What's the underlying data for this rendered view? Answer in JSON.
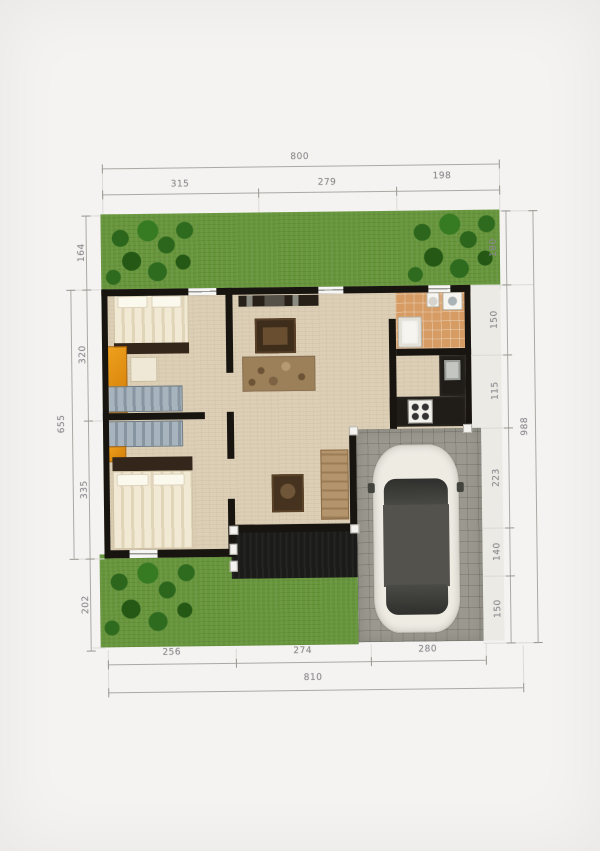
{
  "colors": {
    "bg": "#f4f3f1",
    "grass": "#66953b",
    "floor": "#dccfb6",
    "wall": "#181510",
    "carport": "#9b998f",
    "terrace": "#1b1b19",
    "bath-tile": "#d69c64",
    "furniture-orange": "#d07c08",
    "furniture-brown": "#3f2d1c",
    "rug": "#9c8059",
    "bed-cream": "#f2e9d4",
    "bed-stripe": "#e0d5b8",
    "closet-gray": "#a8b4bd",
    "car-body": "#edebe2",
    "car-glass": "#53524c",
    "dim-line": "#a9a9a4",
    "dim-text": "#8b8b90"
  },
  "dimensions": {
    "top": {
      "total": "800",
      "segments": [
        "315",
        "279",
        "198"
      ]
    },
    "bottom": {
      "total": "810",
      "segments": [
        "256",
        "274",
        "280"
      ]
    },
    "left": {
      "outer": "655",
      "segments": [
        "164",
        "320",
        "335",
        "202"
      ]
    },
    "right": {
      "outer": "988",
      "segments": [
        "180",
        "150",
        "115",
        "223",
        "140",
        "150"
      ]
    }
  }
}
